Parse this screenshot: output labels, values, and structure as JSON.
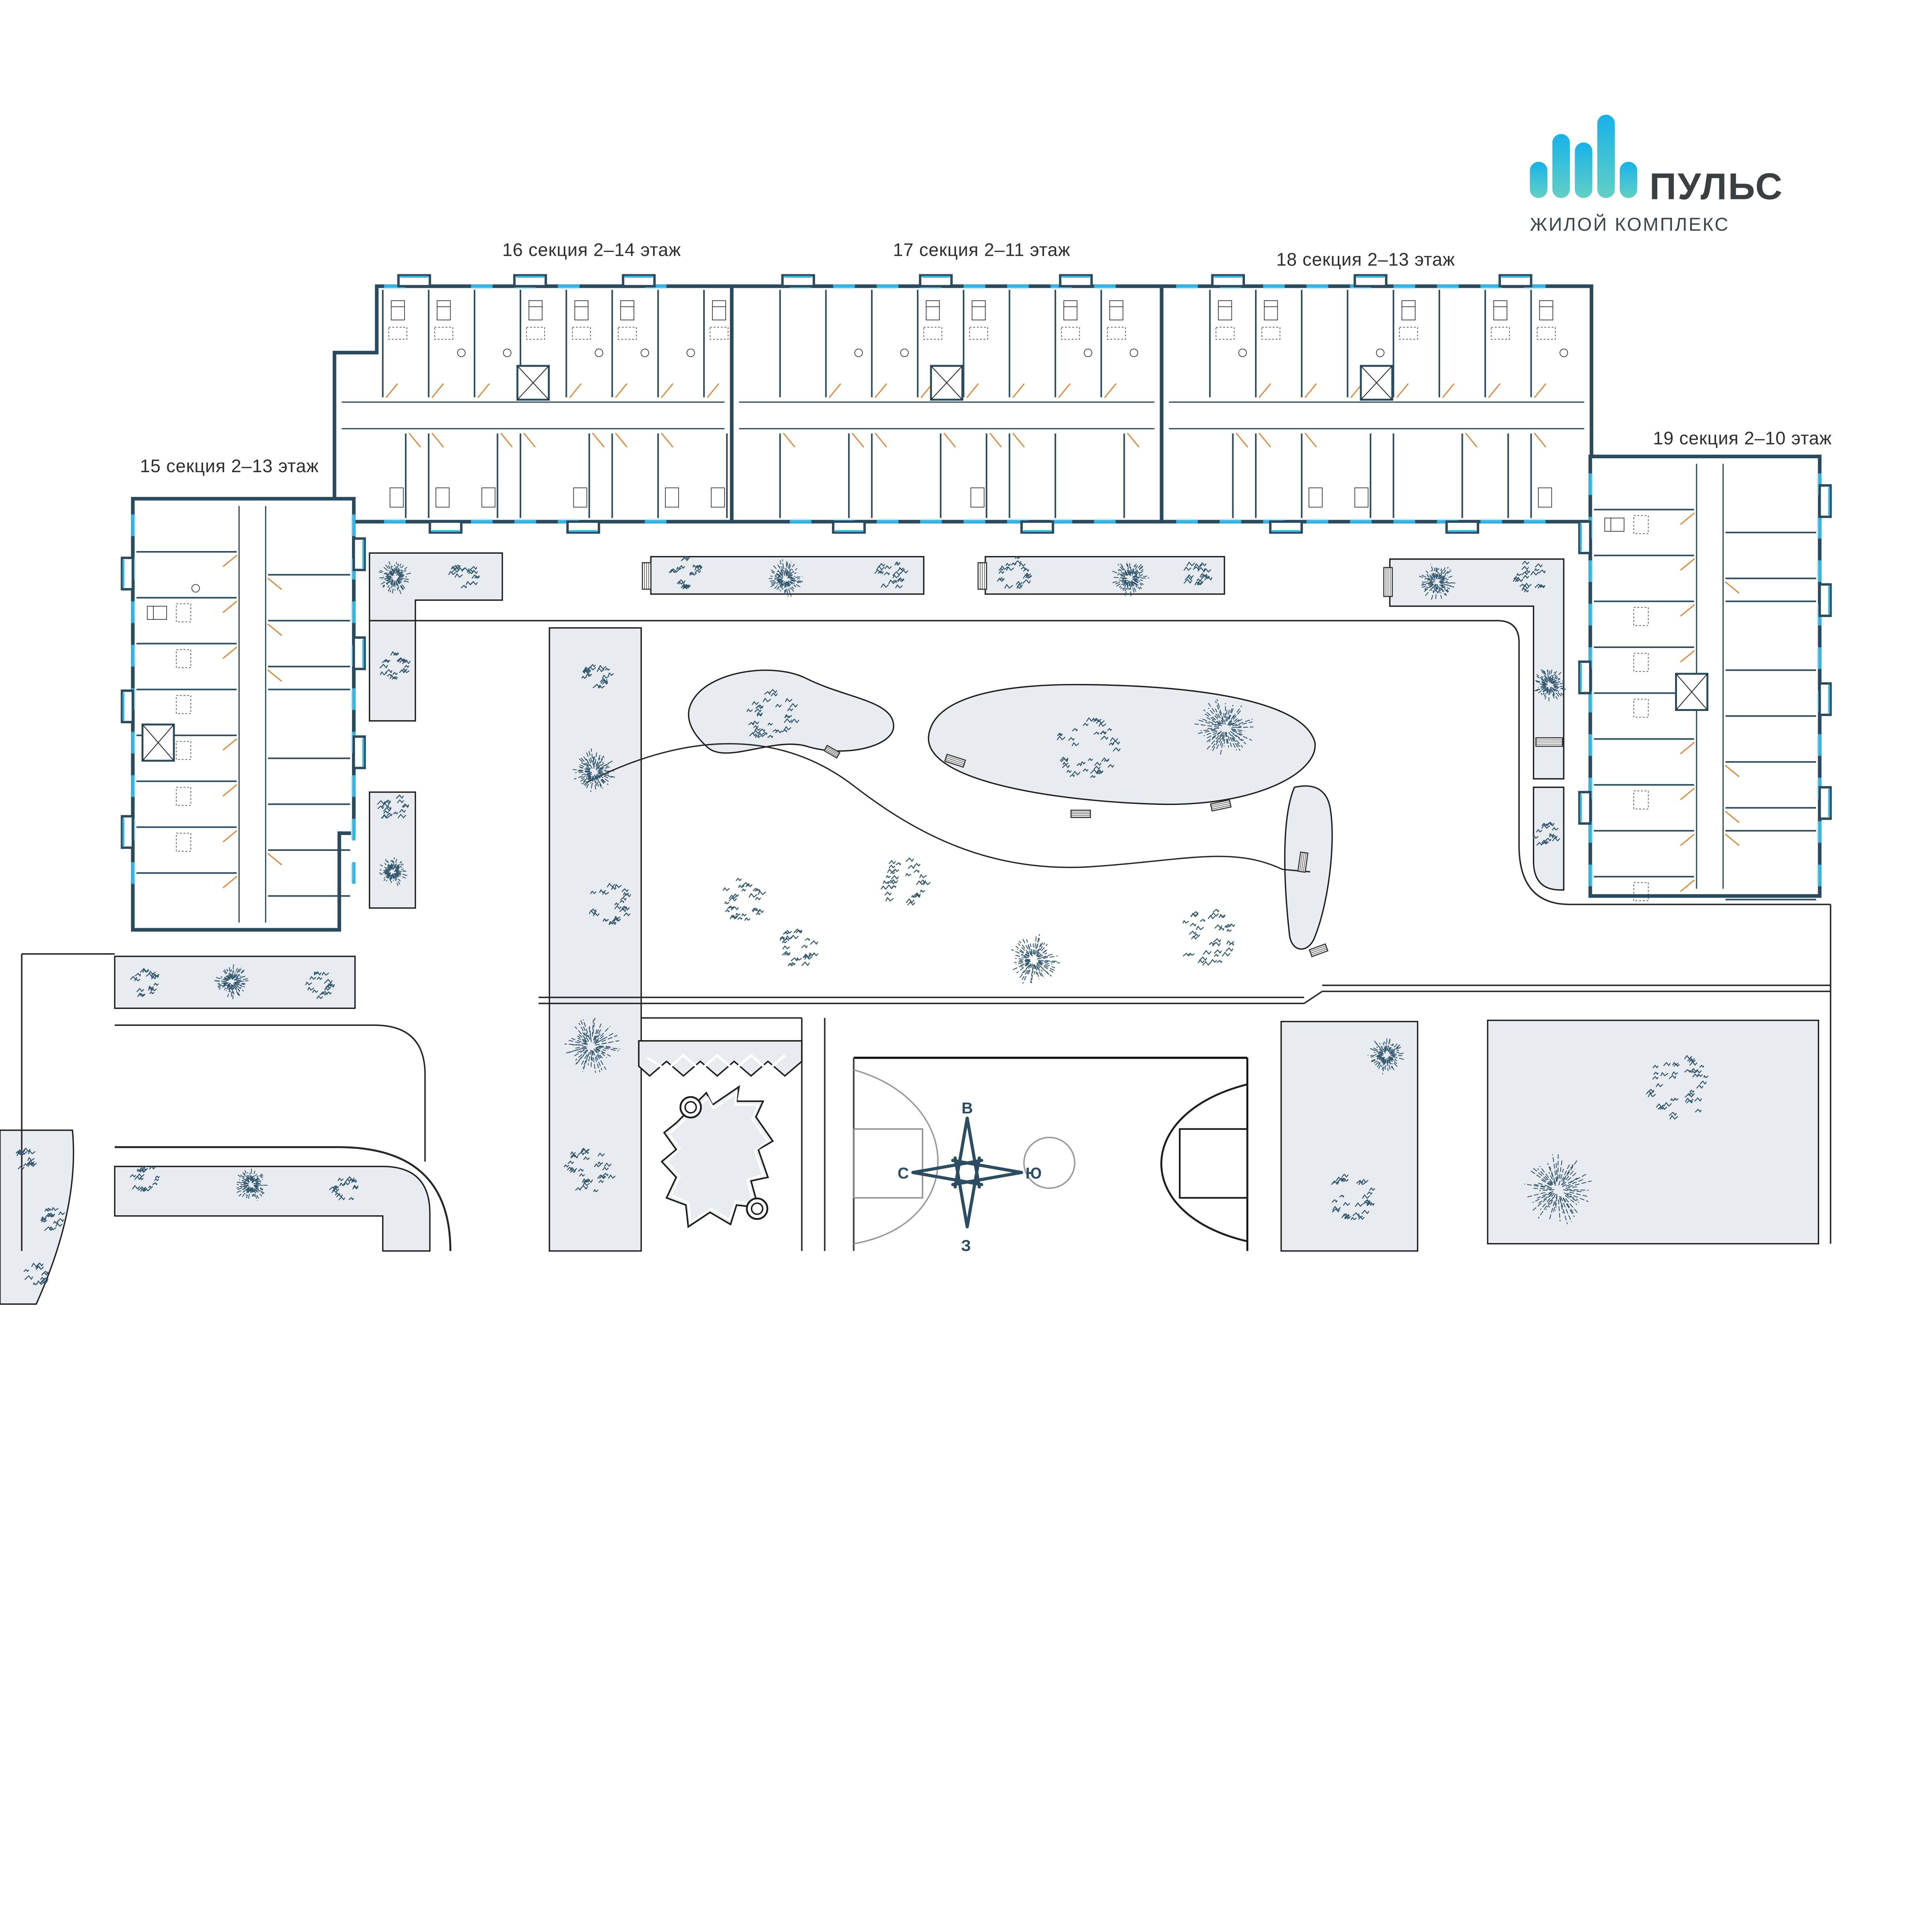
{
  "logo": {
    "title": "ПУЛЬС",
    "subtitle": "ЖИЛОЙ КОМПЛЕКС",
    "icon": "pulse-bars-icon"
  },
  "sections": [
    {
      "id": 15,
      "label": "15 секция 2–13 этаж"
    },
    {
      "id": 16,
      "label": "16 секция 2–14 этаж"
    },
    {
      "id": 17,
      "label": "17 секция 2–11 этаж"
    },
    {
      "id": 18,
      "label": "18 секция 2–13 этаж"
    },
    {
      "id": 19,
      "label": "19 секция 2–10 этаж"
    }
  ],
  "compass": {
    "east": "В",
    "south": "Ю",
    "north": "С",
    "west": "З"
  },
  "amenities": {
    "sports_field": "футбольная площадка",
    "basketball_court": "баскетбольная площадка",
    "playground": "детская площадка"
  },
  "colors": {
    "wall": "#2a4a5e",
    "window": "#35b4e6",
    "window_light": "#bfe8f7",
    "door": "#e0883a",
    "lawn": "#e8ebef",
    "outline": "#1c1c1c",
    "tree": "#31586d",
    "furniture": "#2b2b2b",
    "logo_bar_top": "#17b2e9",
    "logo_bar_bottom": "#62d0c4",
    "compass": "#2b4d61",
    "court_faded": "#8a8a8a",
    "court_dark": "#1d1d1d"
  }
}
